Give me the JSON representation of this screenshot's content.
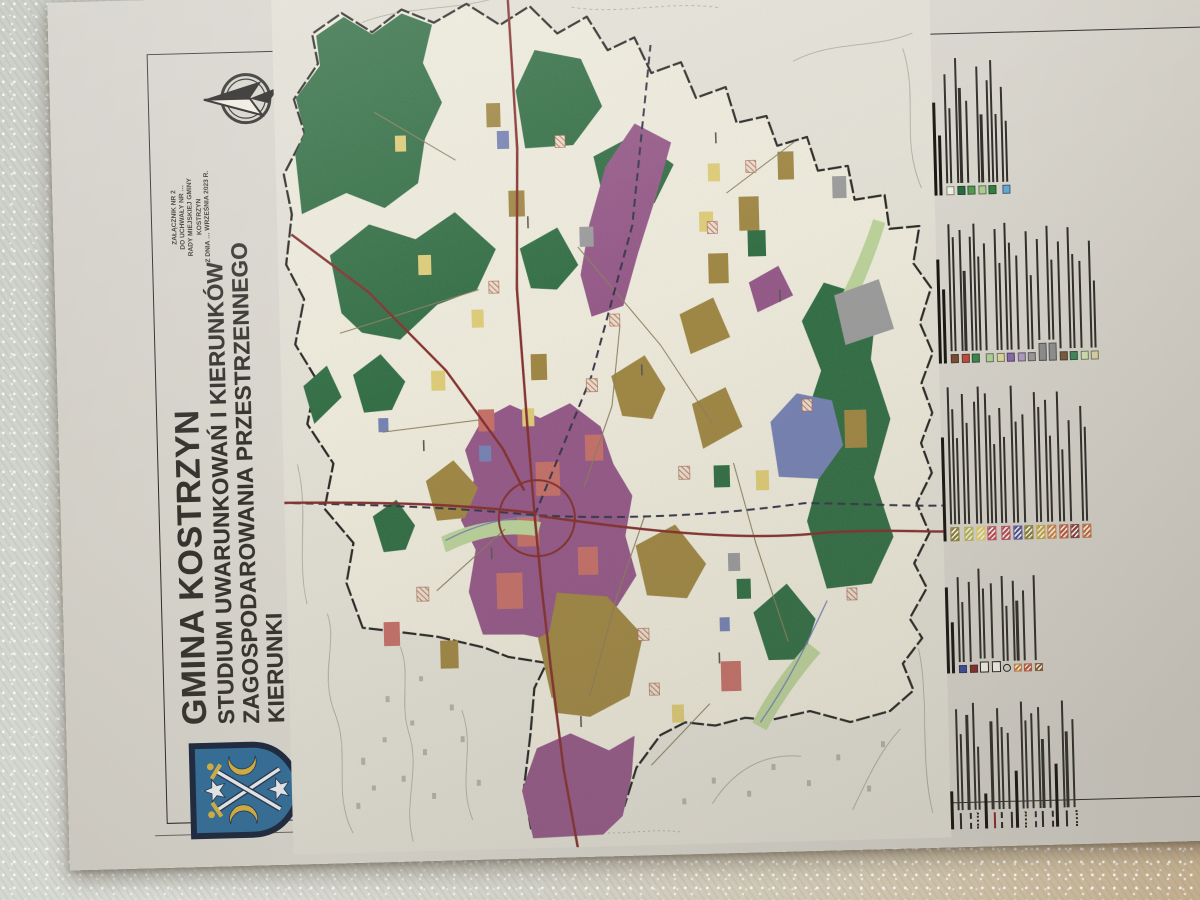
{
  "document": {
    "title": "GMINA KOSTRZYN",
    "subtitle_line1": "STUDIUM UWARUNKOWAŃ I KIERUNKÓW",
    "subtitle_line2": "ZAGOSPODAROWANIA PRZESTRZENNEGO",
    "subtitle_line3": "KIERUNKI",
    "scale": "SKALA 1:10000"
  },
  "annotation": {
    "line1": "ZAŁĄCZNIK NR 2",
    "line2": "DO UCHWAŁY NR …",
    "line3": "RADY MIEJSKIEJ GMINY KOSTRZYN",
    "line4": "Z DNIA … WRZEŚNIA 2023 R."
  },
  "palette": {
    "paper": "#d8d4cb",
    "mapbg": "#e7e4d7",
    "cream": "#f2efdd",
    "forest": "#1f6d38",
    "purple": "#9c4f8c",
    "olive": "#a3842e",
    "salmon": "#d4685f",
    "yellow": "#e5cf62",
    "lgreen": "#b9d78f",
    "blue": "#6f7fbf",
    "gray": "#9b9b9b",
    "road": "#8f2320",
    "rail": "#2c2c46",
    "minor": "#8a7a50",
    "topo": "#a09c90",
    "ink": "#35322c",
    "frame": "#2a2a28",
    "legend_text": "#2f2d28",
    "crest_field": "#2f6f9d",
    "crest_border": "#1a2740",
    "crest_gold": "#d9b23a",
    "crest_silver": "#eceef2"
  },
  "legend": {
    "note": "micro-print legend text illegible at source resolution; rendered as text bars",
    "groups": [
      {
        "id": "boundaries-and-networks",
        "header": null,
        "entries": [
          {
            "bold": true,
            "lines": [
              0.3
            ]
          },
          {
            "line": "solid",
            "lines": [
              0.8,
              0.6
            ]
          },
          {
            "line": "dashed",
            "lines": [
              0.75
            ]
          },
          {
            "line": "dotted",
            "lines": [
              0.85,
              0.5
            ]
          },
          {
            "bold": true,
            "lines": [
              0.28
            ]
          },
          {
            "line": "solid-red",
            "lines": [
              0.7
            ]
          },
          {
            "line": "dashed",
            "lines": [
              0.8,
              0.65
            ]
          },
          {
            "line": "solid",
            "lines": [
              0.6
            ]
          },
          {
            "bold": true,
            "lines": [
              0.45
            ]
          },
          {
            "line": "dotted",
            "lines": [
              0.85,
              0.7
            ]
          },
          {
            "line": "dashed-blue",
            "lines": [
              0.75
            ]
          },
          {
            "line": "solid",
            "lines": [
              0.8,
              0.55
            ]
          },
          {
            "line": "dashed",
            "lines": [
              0.65
            ]
          },
          {
            "bold": true,
            "lines": [
              0.5
            ]
          },
          {
            "line": "solid",
            "lines": [
              0.85,
              0.6
            ]
          },
          {
            "line": "dotted",
            "lines": [
              0.7
            ]
          }
        ]
      },
      {
        "id": "heritage-objects",
        "header": [
          0.75,
          0.45
        ],
        "entries": [
          {
            "sw": "#3a4a9c",
            "small": true,
            "lines": [
              0.85,
              0.6
            ]
          },
          {
            "sw": "#8a2a2a",
            "small": true,
            "lines": [
              0.8
            ]
          },
          {
            "outline2": true,
            "lines": [
              0.9,
              0.7
            ]
          },
          {
            "outline2": true,
            "lines": [
              0.75
            ]
          },
          {
            "glyph": true,
            "lines": [
              0.85,
              0.55
            ]
          },
          {
            "sw": "#d07e38",
            "hatch": true,
            "small": true,
            "lines": [
              0.8,
              0.6
            ]
          },
          {
            "sw": "#c25438",
            "hatch": true,
            "small": true,
            "lines": [
              0.7
            ]
          },
          {
            "sw": "#8a5a2e",
            "hatch": true,
            "small": true,
            "lines": [
              0.85
            ]
          }
        ]
      },
      {
        "id": "development-zones",
        "header": [
          0.66
        ],
        "entries": [
          {
            "sw": "#8a7d2e",
            "hatch": true,
            "lines": [
              0.95,
              0.8,
              0.6
            ]
          },
          {
            "sw": "#b5b44a",
            "hatch": true,
            "lines": [
              0.9,
              0.7
            ]
          },
          {
            "sw": "#e2cd58",
            "hatch": true,
            "lines": [
              0.85,
              0.95
            ]
          },
          {
            "sw": "#c2465a",
            "hatch": true,
            "wide": true,
            "lines": [
              0.9,
              0.75,
              0.55
            ]
          },
          {
            "sw": "#c2465a",
            "hatch": true,
            "lines": [
              0.8,
              0.6
            ]
          },
          {
            "sw": "#4f4f9e",
            "hatch": true,
            "lines": [
              0.95,
              0.7
            ]
          },
          {
            "sw": "#8a7d2e",
            "hatch": true,
            "lines": [
              0.75
            ]
          },
          {
            "sw": "#c8a436",
            "hatch": true,
            "lines": [
              0.9,
              0.8
            ]
          },
          {
            "sw": "#d07e38",
            "hatch": true,
            "lines": [
              0.85,
              0.6
            ]
          },
          {
            "sw": "#c25438",
            "hatch": true,
            "lines": [
              0.9,
              0.5
            ]
          },
          {
            "sw": "#8a3a3a",
            "hatch": true,
            "lines": [
              0.7
            ]
          },
          {
            "sw": "#c8683a",
            "hatch": true,
            "lines": [
              0.8,
              0.65
            ]
          }
        ]
      },
      {
        "id": "special-conditions",
        "header": [
          0.7,
          0.5
        ],
        "entries": [
          {
            "sw": "#7a4a2e",
            "lines": [
              0.95,
              0.85
            ]
          },
          {
            "sw": "#c34a38",
            "lines": [
              0.9,
              0.6
            ]
          },
          {
            "sw": "#38874a",
            "lines": [
              0.85,
              0.95,
              0.7
            ]
          },
          {
            "sw": "#b2d295",
            "lines": [
              0.8
            ]
          },
          {
            "sw": "#e0d898",
            "lines": [
              0.9,
              0.65
            ]
          },
          {
            "sw": "#8a68b0",
            "lines": [
              0.95,
              0.8
            ]
          },
          {
            "sw": "#b09ac6",
            "lines": [
              0.7
            ]
          },
          {
            "sw": "#9a9a9a",
            "lines": [
              0.88,
              0.55
            ]
          },
          {
            "sw": "#8c8c8c",
            "wide": true,
            "lines": [
              0.75
            ]
          },
          {
            "sw": "#8f8f8f",
            "wide": true,
            "lines": [
              0.85,
              0.6
            ]
          },
          {
            "sw": "#7a5a38",
            "lines": [
              0.8
            ]
          },
          {
            "sw": "#3a8a55",
            "lines": [
              0.9,
              0.7
            ]
          },
          {
            "sw": "#cfe0ac",
            "lines": [
              0.65
            ]
          },
          {
            "sw": "#d8d2a0",
            "lines": [
              0.8,
              0.5
            ]
          }
        ]
      },
      {
        "id": "excluded-from-development",
        "header": [
          0.62,
          0.4
        ],
        "entries": [
          {
            "sw": "#f3f0e0",
            "lines": [
              0.8,
              0.55
            ]
          },
          {
            "sw": "#1f6d38",
            "lines": [
              0.92,
              0.7
            ]
          },
          {
            "sw": "#4d9a4a",
            "lines": [
              0.6
            ]
          },
          {
            "sw": "#a9cf8b",
            "lines": [
              0.85,
              0.5
            ]
          },
          {
            "sw": "#2e7d3a",
            "lines": [
              0.75,
              0.9,
              0.5
            ]
          },
          {
            "sw": "#5fa8d8",
            "lines": [
              0.7,
              0.45
            ]
          }
        ]
      }
    ]
  }
}
